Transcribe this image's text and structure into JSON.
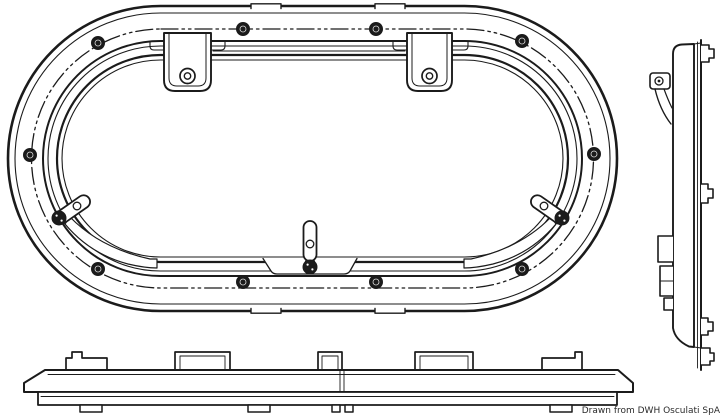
{
  "page": {
    "background_color": "#ffffff",
    "line_color": "#1b1b1b"
  },
  "caption": {
    "text": "Drawn from DWH Osculati SpA"
  },
  "drawing": {
    "subject": "oval portlight technical line drawing",
    "views": [
      {
        "id": "front-view",
        "semantic": "front elevation of oval portlight frame"
      },
      {
        "id": "side-view",
        "semantic": "right side profile of portlight"
      },
      {
        "id": "bottom-view",
        "semantic": "bottom profile of portlight frame"
      }
    ],
    "features": {
      "perimeter_screws": 10,
      "hinge_brackets": 2,
      "latch_handles": 3,
      "bolt_line_style": "dash-dot-dot centerline"
    }
  }
}
